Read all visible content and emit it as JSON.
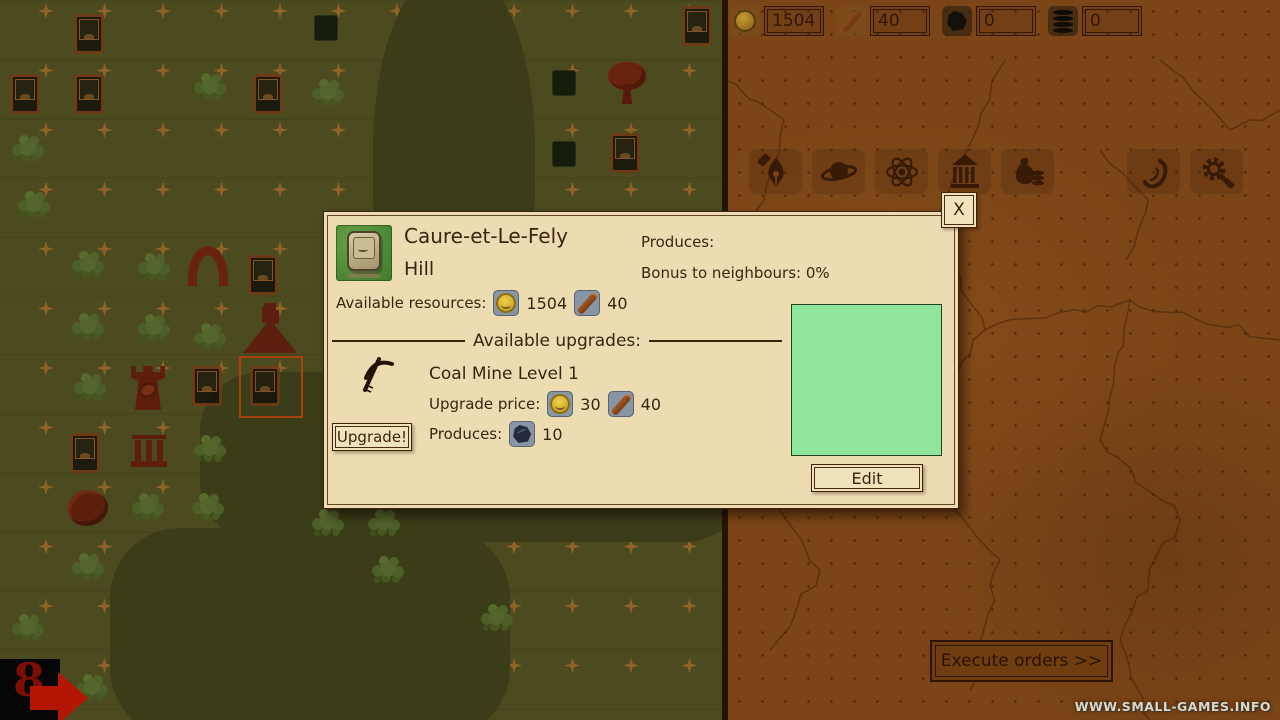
{
  "top_bar": {
    "resources": [
      {
        "id": "gold",
        "icon": "coin",
        "value": "1504"
      },
      {
        "id": "wood",
        "icon": "wood",
        "value": "40"
      },
      {
        "id": "coal",
        "icon": "coal",
        "value": "0"
      },
      {
        "id": "barrels",
        "icon": "barrel",
        "value": "0"
      }
    ]
  },
  "action_bar": {
    "icons": [
      {
        "id": "pen"
      },
      {
        "id": "planet"
      },
      {
        "id": "atom"
      },
      {
        "id": "temple"
      },
      {
        "id": "treasury"
      },
      {
        "id": "ear"
      },
      {
        "id": "settings"
      }
    ]
  },
  "dialog": {
    "close_label": "X",
    "title": "Caure-et-Le-Fely",
    "subtitle": "Hill",
    "produces_label": "Produces:",
    "bonus_label": "Bonus to neighbours: 0%",
    "available_resources_label": "Available resources:",
    "available_resources": [
      {
        "icon": "coin",
        "value": "1504"
      },
      {
        "icon": "wood",
        "value": "40"
      }
    ],
    "upgrades_divider_label": "Available upgrades:",
    "upgrade": {
      "name": "Coal Mine Level 1",
      "price_label": "Upgrade price:",
      "price": [
        {
          "icon": "coin",
          "value": "30"
        },
        {
          "icon": "wood",
          "value": "40"
        }
      ],
      "produces_label": "Produces:",
      "produces": [
        {
          "icon": "coal",
          "value": "10"
        }
      ],
      "button_label": "Upgrade!"
    },
    "edit_button_label": "Edit",
    "preview_color": "#8fe59b"
  },
  "orders": {
    "execute_label": "Execute orders >>"
  },
  "turn": {
    "number": "8"
  },
  "watermark": "WWW.SMALL-GAMES.INFO",
  "colors": {
    "map_olive": "#4c4a1f",
    "river": "#3a3d17",
    "parchment": "#7b4517",
    "dialog_cream": "#eddcb1",
    "selection": "#a8430f",
    "preview_green": "#8fe59b",
    "arrow_red": "#b51505"
  },
  "map": {
    "sparkle_grid": {
      "x0": 46,
      "y0": 11,
      "dx": 58.5,
      "dy": 59.5,
      "cols": 12,
      "rows": 12
    },
    "rivers": [
      {
        "x": 373,
        "y": -30,
        "w": 162,
        "h": 400,
        "r": "45%"
      },
      {
        "x": 200,
        "y": 372,
        "w": 545,
        "h": 170,
        "r": "60px"
      },
      {
        "x": 228,
        "y": 462,
        "w": 86,
        "h": 110,
        "r": "40px"
      },
      {
        "x": 110,
        "y": 528,
        "w": 400,
        "h": 210,
        "r": "70px"
      }
    ],
    "trees": [
      [
        190,
        68
      ],
      [
        308,
        74
      ],
      [
        8,
        130
      ],
      [
        14,
        186
      ],
      [
        68,
        246
      ],
      [
        134,
        248
      ],
      [
        68,
        308
      ],
      [
        134,
        309
      ],
      [
        190,
        318
      ],
      [
        70,
        368
      ],
      [
        190,
        430
      ],
      [
        128,
        488
      ],
      [
        188,
        488
      ],
      [
        308,
        504
      ],
      [
        364,
        504
      ],
      [
        68,
        548
      ],
      [
        368,
        551
      ],
      [
        8,
        609
      ],
      [
        72,
        669
      ],
      [
        477,
        599
      ]
    ],
    "hill_tiles": [
      [
        74,
        14
      ],
      [
        10,
        74
      ],
      [
        74,
        74
      ],
      [
        253,
        74
      ],
      [
        610,
        133
      ],
      [
        248,
        255
      ],
      [
        192,
        366
      ],
      [
        250,
        366
      ],
      [
        70,
        433
      ],
      [
        682,
        6
      ]
    ],
    "dark_tiles": [
      [
        314,
        15
      ],
      [
        552,
        70
      ],
      [
        552,
        141
      ]
    ],
    "landmarks": [
      {
        "type": "arch",
        "x": 186,
        "y": 246
      },
      {
        "type": "volcano",
        "x": 243,
        "y": 303
      },
      {
        "type": "rook",
        "x": 131,
        "y": 366
      },
      {
        "type": "columns",
        "x": 128,
        "y": 430
      },
      {
        "type": "redtree",
        "x": 604,
        "y": 62
      },
      {
        "type": "mushroom",
        "x": 68,
        "y": 490
      }
    ],
    "selection": {
      "x": 239,
      "y": 356,
      "w": 64,
      "h": 62
    }
  }
}
